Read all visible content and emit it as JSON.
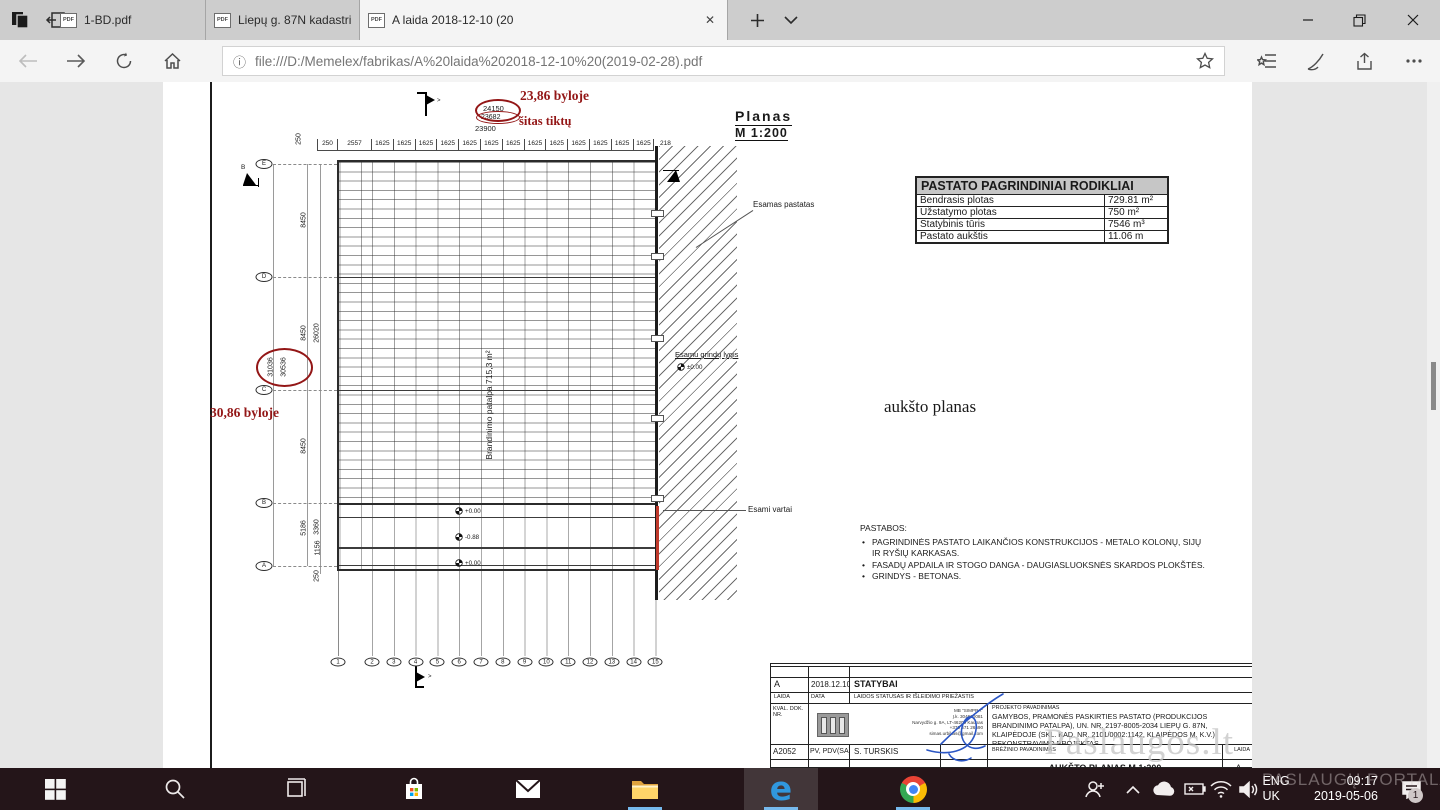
{
  "browser": {
    "tabs": [
      {
        "title": "1-BD.pdf",
        "active": false
      },
      {
        "title": "Liepų g. 87N kadastrinė byl",
        "active": false
      },
      {
        "title": "A laida 2018-12-10 (20",
        "active": true
      }
    ],
    "new_tab_label": "+",
    "url": "file:///D:/Memelex/fabrikas/A%20laida%202018-12-10%20(2019-02-28).pdf"
  },
  "plan": {
    "title": "Planas",
    "scale": "M 1:200",
    "annotations": {
      "top_red": "23,86 byloje",
      "mid_red": "šitas tiktų",
      "left_red": "30,86 byloje"
    },
    "dims": {
      "top_total_1": "24150",
      "top_total_2": "23682",
      "top_total_3": "23900",
      "top_first": "250",
      "top_vert": "250",
      "top_seg_first": "2557",
      "top_seg_repeat": "1625",
      "top_seg_count": 13,
      "top_seg_last": "218",
      "left_row_segs": [
        "8450",
        "8450",
        "8450",
        "5186"
      ],
      "left_inner": [
        "26020",
        "3360",
        "1156"
      ],
      "left_totals": [
        "31036",
        "30536"
      ],
      "left_top": "250",
      "left_bottom": "250"
    },
    "grid_rows": [
      "E",
      "D",
      "C",
      "B",
      "A"
    ],
    "grid_cols": [
      "1",
      "2",
      "3",
      "4",
      "5",
      "6",
      "7",
      "8",
      "9",
      "10",
      "11",
      "12",
      "13",
      "14",
      "15"
    ],
    "room_label": "Brandinimo patalpa 715,3 m²",
    "elevations": [
      "+0.00",
      "-0.88",
      "+0.00"
    ],
    "section_letter": "B",
    "callouts": {
      "existing_building": "Esamas pastatas",
      "existing_floor": "Esamu grindų lygis",
      "existing_floor_level": "±0.00",
      "existing_gate": "Esami vartai"
    }
  },
  "indicators": {
    "title": "PASTATO PAGRINDINIAI RODIKLIAI",
    "rows": [
      {
        "label": "Bendrasis plotas",
        "value": "729.81 m²"
      },
      {
        "label": "Užstatymo plotas",
        "value": "750 m²"
      },
      {
        "label": "Statybinis tūris",
        "value": "7546 m³"
      },
      {
        "label": "Pastato aukštis",
        "value": "11.06 m"
      }
    ]
  },
  "plan_name_note": "aukšto planas",
  "notes": {
    "title": "PASTABOS:",
    "items": [
      "PAGRINDINĖS PASTATO LAIKANČIOS KONSTRUKCIJOS - METALO KOLONŲ, SIJŲ IR RYŠIŲ KARKASAS.",
      "FASADŲ APDAILA IR STOGO DANGA - DAUGIASLUOKSNĖS SKARDOS PLOKŠTĖS.",
      "GRINDYS - BETONAS."
    ]
  },
  "title_block": {
    "rev": "A",
    "rev_date": "2018.12.10",
    "rev_status": "STATYBAI",
    "col_laida": "LAIDA",
    "col_data": "DATA",
    "col_status": "LAIDOS STATUSAS IR IŠLEIDIMO PRIEŽASTIS",
    "kval": "KVAL. DOK. NR.",
    "company_lines": [
      "MB \"SIMPRA\"",
      "Į.k. 304600081",
      "Narvydžio g. 9A, LT-46209 Kaunas",
      "+370 671 26590",
      "simas.urbikas@gmail.com"
    ],
    "project_label": "PROJEKTO PAVADINIMAS",
    "project_name": "GAMYBOS, PRAMONĖS PASKIRTIES PASTATO (PRODUKCIJOS BRANDINIMO PATALPA), UN. NR. 2197-8005-2034 LIEPŲ G. 87N, KLAIPĖDOJE (SKL. KAD. NR. 2101/0002:1142, KLAIPĖDOS M. K.V.) REKONSTRAVIMO PROJEKTAS",
    "attest": "A2052",
    "role": "PV, PDV(SA)",
    "name": "S. TURSKIS",
    "drawing_label": "BRĖŽINIO PAVADINIMAS",
    "drawing_name": "AUKŠTO PLANAS M 1:200",
    "laida_label": "LAIDA"
  },
  "watermark": {
    "line1": "Paslaugos.lt",
    "line2": "PASLAUGŲ PORTALAS Nr. 1"
  },
  "taskbar": {
    "lang_top": "ENG",
    "lang_bottom": "UK",
    "time": "09:17",
    "date": "2019-05-06",
    "badge": "1"
  }
}
